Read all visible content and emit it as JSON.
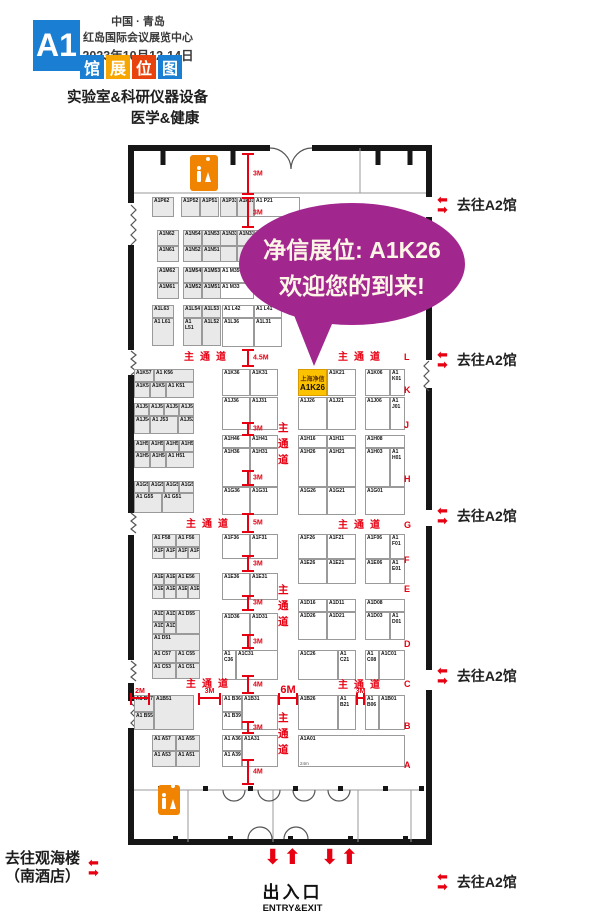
{
  "header": {
    "hall_badge": "A1",
    "location_line1": "中国 · 青岛",
    "location_line2": "红岛国际会议展览中心",
    "date_line": "2023年10月12-14日",
    "title_tiles": [
      {
        "char": "馆",
        "color": "#1a7fd2"
      },
      {
        "char": "展",
        "color": "#f7a600"
      },
      {
        "char": "位",
        "color": "#e8420d"
      },
      {
        "char": "图",
        "color": "#1a7fd2"
      }
    ],
    "subtitle_line1": "实验室&科研仪器设备",
    "subtitle_line2": "医学&健康"
  },
  "callout": {
    "line1": "净信展位: A1K26",
    "line2": "欢迎您的到来!",
    "color": "#a1268e"
  },
  "highlight_booth": {
    "company": "上海净信",
    "booth": "A1K26"
  },
  "map": {
    "booths": [
      [
        "A1P62",
        24,
        52,
        22,
        20,
        1
      ],
      [
        "A1P52",
        53,
        52,
        19,
        20,
        1
      ],
      [
        "A1P51",
        72,
        52,
        19,
        20,
        1
      ],
      [
        "A1P33",
        92,
        52,
        17,
        20,
        1
      ],
      [
        "A1P31",
        109,
        52,
        17,
        20,
        1
      ],
      [
        "A1 P21",
        126,
        52,
        46,
        20,
        0
      ],
      [
        "A1N62",
        29,
        85,
        22,
        16,
        1
      ],
      [
        "A1N61",
        29,
        101,
        22,
        16,
        1
      ],
      [
        "A1N54",
        55,
        85,
        19,
        16,
        1
      ],
      [
        "A1N53",
        74,
        85,
        19,
        16,
        1
      ],
      [
        "A1N52",
        55,
        101,
        19,
        16,
        1
      ],
      [
        "A1N51",
        74,
        101,
        19,
        16,
        1
      ],
      [
        "A1N33",
        92,
        85,
        17,
        16,
        1
      ],
      [
        "A1N31",
        109,
        85,
        17,
        16,
        1
      ],
      [
        "",
        92,
        101,
        17,
        16,
        1
      ],
      [
        "",
        109,
        101,
        17,
        16,
        1
      ],
      [
        "",
        126,
        85,
        23,
        16,
        1
      ],
      [
        "",
        126,
        101,
        23,
        16,
        1
      ],
      [
        "A1M62",
        29,
        122,
        22,
        16,
        1
      ],
      [
        "A1M61",
        29,
        138,
        22,
        16,
        1
      ],
      [
        "A1M54",
        55,
        122,
        19,
        16,
        1
      ],
      [
        "A1M53",
        74,
        122,
        19,
        16,
        1
      ],
      [
        "A1M52",
        55,
        138,
        19,
        16,
        1
      ],
      [
        "A1M51",
        74,
        138,
        19,
        16,
        1
      ],
      [
        "A1 M35",
        92,
        122,
        34,
        16,
        0
      ],
      [
        "A1 M33",
        92,
        138,
        34,
        16,
        0
      ],
      [
        "A1L63",
        24,
        160,
        22,
        13,
        1
      ],
      [
        "A1 L61",
        24,
        173,
        22,
        28,
        1
      ],
      [
        "A1L54",
        55,
        160,
        19,
        13,
        1
      ],
      [
        "A1L53",
        74,
        160,
        19,
        13,
        1
      ],
      [
        "A1 L51",
        55,
        173,
        19,
        28,
        1
      ],
      [
        "A1L52",
        74,
        173,
        19,
        28,
        1
      ],
      [
        "A1 L42",
        94,
        160,
        32,
        13,
        0
      ],
      [
        "A1 L41",
        126,
        160,
        28,
        13,
        0
      ],
      [
        "A1L36",
        94,
        173,
        32,
        29,
        0
      ],
      [
        "A1L31",
        126,
        173,
        28,
        29,
        0
      ],
      [
        "A1K57",
        6,
        224,
        20,
        13,
        1
      ],
      [
        "A1 K56",
        26,
        224,
        40,
        13,
        1
      ],
      [
        "A1K53",
        6,
        237,
        16,
        16,
        1
      ],
      [
        "A1K52",
        22,
        237,
        16,
        16,
        1
      ],
      [
        "A1 K51",
        38,
        237,
        28,
        16,
        1
      ],
      [
        "A1K36",
        94,
        224,
        28,
        27,
        0
      ],
      [
        "A1K31",
        122,
        224,
        28,
        27,
        0
      ],
      [
        "A1K26",
        170,
        224,
        29,
        27,
        2
      ],
      [
        "A1K21",
        199,
        224,
        29,
        27,
        0
      ],
      [
        "A1K06",
        237,
        224,
        25,
        27,
        0
      ],
      [
        "A1 K01",
        262,
        224,
        15,
        27,
        0
      ],
      [
        "A1J58",
        6,
        258,
        15,
        13,
        1
      ],
      [
        "A1J57",
        21,
        258,
        15,
        13,
        1
      ],
      [
        "A1J56",
        36,
        258,
        15,
        13,
        1
      ],
      [
        "A1J51",
        51,
        258,
        15,
        13,
        1
      ],
      [
        "A1J54",
        6,
        271,
        16,
        18,
        1
      ],
      [
        "A1 J53",
        22,
        271,
        28,
        18,
        1
      ],
      [
        "A1J52",
        50,
        271,
        16,
        18,
        1
      ],
      [
        "A1J36",
        94,
        252,
        28,
        33,
        0
      ],
      [
        "A1J31",
        122,
        252,
        28,
        33,
        0
      ],
      [
        "A1J26",
        170,
        252,
        29,
        33,
        0
      ],
      [
        "A1J21",
        199,
        252,
        29,
        33,
        0
      ],
      [
        "A1J06",
        237,
        252,
        25,
        33,
        0
      ],
      [
        "A1 J01",
        262,
        252,
        15,
        33,
        0
      ],
      [
        "A1H58",
        6,
        295,
        15,
        12,
        1
      ],
      [
        "A1H57",
        21,
        295,
        15,
        12,
        1
      ],
      [
        "A1H56",
        36,
        295,
        15,
        12,
        1
      ],
      [
        "A1H55",
        51,
        295,
        15,
        12,
        1
      ],
      [
        "A1H54",
        6,
        307,
        16,
        16,
        1
      ],
      [
        "A1H53",
        22,
        307,
        16,
        16,
        1
      ],
      [
        "A1 H51",
        38,
        307,
        28,
        16,
        1
      ],
      [
        "A1H46",
        94,
        290,
        28,
        13,
        0
      ],
      [
        "A1H41",
        122,
        290,
        28,
        13,
        0
      ],
      [
        "A1H36",
        94,
        303,
        28,
        39,
        0
      ],
      [
        "A1H31",
        122,
        303,
        28,
        39,
        0
      ],
      [
        "A1H16",
        170,
        290,
        29,
        13,
        0
      ],
      [
        "A1H11",
        199,
        290,
        29,
        13,
        0
      ],
      [
        "A1H26",
        170,
        303,
        29,
        39,
        0
      ],
      [
        "A1H21",
        199,
        303,
        29,
        39,
        0
      ],
      [
        "A1H08",
        237,
        290,
        40,
        13,
        0
      ],
      [
        "A1H03",
        237,
        303,
        25,
        39,
        0
      ],
      [
        "A1 H01",
        262,
        303,
        15,
        39,
        0
      ],
      [
        "A1G57",
        6,
        336,
        15,
        12,
        1
      ],
      [
        "A1G58",
        21,
        336,
        15,
        12,
        1
      ],
      [
        "A1G56",
        36,
        336,
        15,
        12,
        1
      ],
      [
        "A1G52",
        51,
        336,
        15,
        12,
        1
      ],
      [
        "A1 G55",
        6,
        348,
        28,
        20,
        1
      ],
      [
        "A1 G51",
        34,
        348,
        32,
        20,
        1
      ],
      [
        "A1G36",
        94,
        342,
        28,
        28,
        0
      ],
      [
        "A1G31",
        122,
        342,
        28,
        28,
        0
      ],
      [
        "A1G26",
        170,
        342,
        29,
        28,
        0
      ],
      [
        "A1G21",
        199,
        342,
        29,
        28,
        0
      ],
      [
        "A1G01",
        237,
        342,
        40,
        28,
        0
      ],
      [
        "A1 F58",
        24,
        389,
        24,
        13,
        1
      ],
      [
        "A1 F56",
        48,
        389,
        24,
        13,
        1
      ],
      [
        "A1F54",
        24,
        402,
        12,
        12,
        1
      ],
      [
        "A1F53",
        36,
        402,
        12,
        12,
        1
      ],
      [
        "A1F52",
        48,
        402,
        12,
        12,
        1
      ],
      [
        "A1F51",
        60,
        402,
        12,
        12,
        1
      ],
      [
        "A1F36",
        94,
        389,
        28,
        25,
        0
      ],
      [
        "A1F31",
        122,
        389,
        28,
        25,
        0
      ],
      [
        "A1F26",
        170,
        389,
        29,
        25,
        0
      ],
      [
        "A1F21",
        199,
        389,
        29,
        25,
        0
      ],
      [
        "A1F06",
        237,
        389,
        25,
        25,
        0
      ],
      [
        "A1 F01",
        262,
        389,
        15,
        25,
        0
      ],
      [
        "A1E26",
        170,
        414,
        29,
        25,
        0
      ],
      [
        "A1E21",
        199,
        414,
        29,
        25,
        0
      ],
      [
        "A1E06",
        237,
        414,
        25,
        25,
        0
      ],
      [
        "A1 E01",
        262,
        414,
        15,
        25,
        0
      ],
      [
        "A1E58",
        24,
        428,
        12,
        12,
        1
      ],
      [
        "A1E57",
        36,
        428,
        12,
        12,
        1
      ],
      [
        "A1 E56",
        48,
        428,
        24,
        12,
        1
      ],
      [
        "A1E54",
        24,
        440,
        12,
        14,
        1
      ],
      [
        "A1E53",
        36,
        440,
        12,
        14,
        1
      ],
      [
        "A1E52",
        48,
        440,
        12,
        14,
        1
      ],
      [
        "A1E51",
        60,
        440,
        12,
        14,
        1
      ],
      [
        "A1E36",
        94,
        428,
        28,
        27,
        0
      ],
      [
        "A1E31",
        122,
        428,
        28,
        27,
        0
      ],
      [
        "A1D57",
        24,
        465,
        12,
        12,
        1
      ],
      [
        "A1D58",
        36,
        465,
        12,
        12,
        1
      ],
      [
        "A1 D55",
        48,
        465,
        24,
        24,
        1
      ],
      [
        "A1D56",
        24,
        477,
        12,
        12,
        1
      ],
      [
        "A1D53",
        36,
        477,
        12,
        12,
        1
      ],
      [
        "A1 D51",
        24,
        489,
        48,
        18,
        1
      ],
      [
        "A1D36",
        94,
        468,
        28,
        40,
        0
      ],
      [
        "A1D31",
        122,
        468,
        28,
        40,
        0
      ],
      [
        "A1D16",
        170,
        454,
        29,
        13,
        0
      ],
      [
        "A1D11",
        199,
        454,
        29,
        13,
        0
      ],
      [
        "A1D08",
        237,
        454,
        40,
        13,
        0
      ],
      [
        "A1D26",
        170,
        467,
        29,
        28,
        0
      ],
      [
        "A1D21",
        199,
        467,
        29,
        28,
        0
      ],
      [
        "A1D03",
        237,
        467,
        25,
        28,
        0
      ],
      [
        "A1 D01",
        262,
        467,
        15,
        28,
        0
      ],
      [
        "A1 C57",
        24,
        505,
        24,
        13,
        1
      ],
      [
        "A1 C55",
        48,
        505,
        24,
        13,
        1
      ],
      [
        "A1 C53",
        24,
        518,
        24,
        16,
        1
      ],
      [
        "A1 C51",
        48,
        518,
        24,
        16,
        1
      ],
      [
        "A1 C36",
        94,
        505,
        14,
        30,
        0
      ],
      [
        "A1C31",
        108,
        505,
        42,
        30,
        0
      ],
      [
        "A1C26",
        170,
        505,
        40,
        30,
        0
      ],
      [
        "A1 C21",
        210,
        505,
        18,
        30,
        0
      ],
      [
        "A1 C08",
        237,
        505,
        14,
        30,
        0
      ],
      [
        "A1C01",
        251,
        505,
        26,
        30,
        0
      ],
      [
        "A1 B57",
        6,
        550,
        20,
        17,
        1
      ],
      [
        "A1 B55",
        6,
        567,
        20,
        18,
        1
      ],
      [
        "A1B51",
        26,
        550,
        40,
        35,
        1
      ],
      [
        "A1 B36",
        94,
        550,
        20,
        17,
        0
      ],
      [
        "A1 B39",
        94,
        567,
        20,
        18,
        0
      ],
      [
        "A1B31",
        114,
        550,
        36,
        35,
        0
      ],
      [
        "A1B26",
        170,
        550,
        40,
        35,
        0
      ],
      [
        "A1 B21",
        210,
        550,
        18,
        35,
        0
      ],
      [
        "A1 B06",
        237,
        550,
        14,
        35,
        0
      ],
      [
        "A1B01",
        251,
        550,
        26,
        35,
        0
      ],
      [
        "A1 A57",
        24,
        590,
        24,
        16,
        1
      ],
      [
        "A1 A55",
        48,
        590,
        24,
        16,
        1
      ],
      [
        "A1 A53",
        24,
        606,
        24,
        16,
        1
      ],
      [
        "A1 A51",
        48,
        606,
        24,
        16,
        1
      ],
      [
        "A1 A36",
        94,
        590,
        20,
        16,
        0
      ],
      [
        "A1 A39",
        94,
        606,
        20,
        16,
        0
      ],
      [
        "A1A31",
        114,
        590,
        36,
        32,
        0
      ],
      [
        "A1A01",
        170,
        590,
        107,
        32,
        0,
        "24m"
      ]
    ],
    "aisles": [
      {
        "text": "主通道",
        "x": 56,
        "y": 203,
        "v": 0
      },
      {
        "text": "主通道",
        "x": 210,
        "y": 203,
        "v": 0
      },
      {
        "text": "主通道",
        "x": 58,
        "y": 370,
        "v": 0
      },
      {
        "text": "主通道",
        "x": 210,
        "y": 371,
        "v": 0
      },
      {
        "text": "主通道",
        "x": 58,
        "y": 530,
        "v": 0
      },
      {
        "text": "主通道",
        "x": 210,
        "y": 531,
        "v": 0
      },
      {
        "text": "主通道",
        "x": 150,
        "y": 276,
        "v": 1
      },
      {
        "text": "主通道",
        "x": 150,
        "y": 438,
        "v": 1
      },
      {
        "text": "主通道",
        "x": 150,
        "y": 566,
        "v": 1
      }
    ],
    "markers_v": [
      [
        "3M",
        8,
        50
      ],
      [
        "3M",
        52,
        83
      ],
      [
        "4.5M",
        204,
        222
      ],
      [
        "3M",
        277,
        291
      ],
      [
        "3M",
        325,
        341
      ],
      [
        "5M",
        368,
        388
      ],
      [
        "3M",
        410,
        427
      ],
      [
        "3M",
        450,
        466
      ],
      [
        "3M",
        489,
        504
      ],
      [
        "4M",
        530,
        549
      ],
      [
        "3M",
        576,
        589
      ],
      [
        "4M",
        614,
        640
      ]
    ],
    "markers_h": [
      [
        "2M",
        2,
        22
      ],
      [
        "3M",
        70,
        93
      ],
      [
        "6M",
        150,
        170
      ],
      [
        "3M",
        228,
        237
      ]
    ],
    "row_letters": [
      [
        "L",
        207
      ],
      [
        "K",
        240
      ],
      [
        "J",
        275
      ],
      [
        "H",
        329
      ],
      [
        "G",
        375
      ],
      [
        "F",
        410
      ],
      [
        "E",
        439
      ],
      [
        "D",
        494
      ],
      [
        "C",
        534
      ],
      [
        "B",
        576
      ],
      [
        "A",
        615
      ]
    ]
  },
  "signs": {
    "to_a2": "去往A2馆",
    "to_a2_y": [
      195,
      350,
      506,
      666
    ],
    "to_a2_bottom_y": 872,
    "entry_arrow_pair": "⬇⬆",
    "exit_cn": "出入口",
    "exit_en": "ENTRY&EXIT",
    "to_guanhai_line1": "去往观海楼",
    "to_guanhai_line2": "（南酒店）"
  },
  "icons": {
    "arrow_left": "⬅",
    "arrow_right": "➡",
    "arrow_up": "⬆",
    "arrow_down": "⬇"
  },
  "colors": {
    "red": "#e60012",
    "blue": "#1a7fd2",
    "tile_orange": "#f7a600",
    "tile_red": "#e8420d",
    "purple": "#a1268e",
    "highlight": "#fcc200",
    "restroom_orange": "#f08300",
    "booth_gray": "#e9e9e9",
    "wall": "#161616"
  }
}
